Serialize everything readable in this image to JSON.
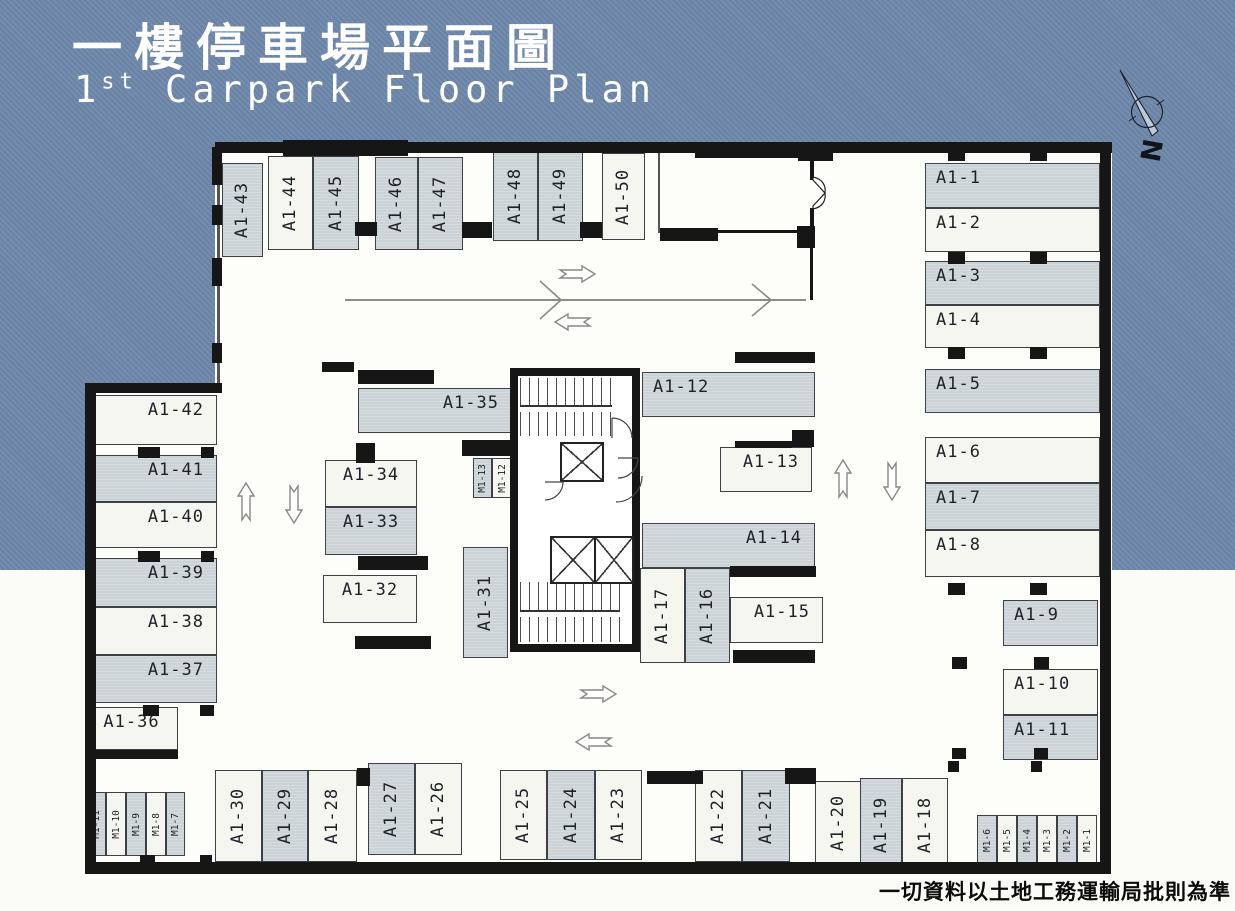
{
  "header": {
    "title_zh": "一樓停車場平面圖",
    "title_en_num": "1",
    "title_en_sup": "st",
    "title_en_rest": " Carpark Floor Plan"
  },
  "compass_label": "N",
  "footer_note": "一切資料以土地工務運輸局批則為準",
  "palette": {
    "background_blue": "#6d87aa",
    "stall_gray": "#ccd3d7",
    "stall_white": "#f6f6f1",
    "wall_black": "#161616"
  },
  "stalls": [
    {
      "label": "A1-43",
      "x": 222,
      "y": 163,
      "w": 41,
      "h": 94,
      "fill": "gray",
      "dir": "v"
    },
    {
      "label": "A1-44",
      "x": 268,
      "y": 156,
      "w": 45,
      "h": 94,
      "fill": "white",
      "dir": "v"
    },
    {
      "label": "A1-45",
      "x": 313,
      "y": 156,
      "w": 46,
      "h": 94,
      "fill": "gray",
      "dir": "v"
    },
    {
      "label": "A1-46",
      "x": 375,
      "y": 157,
      "w": 43,
      "h": 93,
      "fill": "gray",
      "dir": "v"
    },
    {
      "label": "A1-47",
      "x": 418,
      "y": 157,
      "w": 45,
      "h": 93,
      "fill": "gray",
      "dir": "v"
    },
    {
      "label": "A1-48",
      "x": 493,
      "y": 151,
      "w": 45,
      "h": 90,
      "fill": "gray",
      "dir": "v"
    },
    {
      "label": "A1-49",
      "x": 538,
      "y": 151,
      "w": 45,
      "h": 90,
      "fill": "gray",
      "dir": "v"
    },
    {
      "label": "A1-50",
      "x": 602,
      "y": 153,
      "w": 43,
      "h": 87,
      "fill": "white",
      "dir": "v"
    },
    {
      "label": "A1-1",
      "x": 925,
      "y": 163,
      "w": 175,
      "h": 45,
      "fill": "gray",
      "dir": "h",
      "align": "left"
    },
    {
      "label": "A1-2",
      "x": 925,
      "y": 208,
      "w": 175,
      "h": 44,
      "fill": "white",
      "dir": "h",
      "align": "left"
    },
    {
      "label": "A1-3",
      "x": 925,
      "y": 261,
      "w": 175,
      "h": 44,
      "fill": "gray",
      "dir": "h",
      "align": "left"
    },
    {
      "label": "A1-4",
      "x": 925,
      "y": 305,
      "w": 175,
      "h": 43,
      "fill": "white",
      "dir": "h",
      "align": "left"
    },
    {
      "label": "A1-5",
      "x": 925,
      "y": 369,
      "w": 175,
      "h": 44,
      "fill": "gray",
      "dir": "h",
      "align": "left"
    },
    {
      "label": "A1-6",
      "x": 925,
      "y": 437,
      "w": 175,
      "h": 46,
      "fill": "white",
      "dir": "h",
      "align": "left"
    },
    {
      "label": "A1-7",
      "x": 925,
      "y": 483,
      "w": 175,
      "h": 47,
      "fill": "gray",
      "dir": "h",
      "align": "left"
    },
    {
      "label": "A1-8",
      "x": 925,
      "y": 530,
      "w": 175,
      "h": 47,
      "fill": "white",
      "dir": "h",
      "align": "left"
    },
    {
      "label": "A1-9",
      "x": 1003,
      "y": 600,
      "w": 95,
      "h": 46,
      "fill": "gray",
      "dir": "h",
      "align": "left"
    },
    {
      "label": "A1-10",
      "x": 1003,
      "y": 669,
      "w": 95,
      "h": 46,
      "fill": "white",
      "dir": "h",
      "align": "left"
    },
    {
      "label": "A1-11",
      "x": 1003,
      "y": 715,
      "w": 95,
      "h": 45,
      "fill": "gray",
      "dir": "h",
      "align": "left"
    },
    {
      "label": "A1-42",
      "x": 88,
      "y": 395,
      "w": 129,
      "h": 50,
      "fill": "white",
      "dir": "h",
      "align": "right"
    },
    {
      "label": "A1-41",
      "x": 88,
      "y": 455,
      "w": 129,
      "h": 47,
      "fill": "gray",
      "dir": "h",
      "align": "right"
    },
    {
      "label": "A1-40",
      "x": 88,
      "y": 502,
      "w": 129,
      "h": 46,
      "fill": "white",
      "dir": "h",
      "align": "right"
    },
    {
      "label": "A1-39",
      "x": 88,
      "y": 558,
      "w": 129,
      "h": 49,
      "fill": "gray",
      "dir": "h",
      "align": "right"
    },
    {
      "label": "A1-38",
      "x": 88,
      "y": 607,
      "w": 129,
      "h": 48,
      "fill": "white",
      "dir": "h",
      "align": "right"
    },
    {
      "label": "A1-37",
      "x": 88,
      "y": 655,
      "w": 129,
      "h": 48,
      "fill": "gray",
      "dir": "h",
      "align": "right"
    },
    {
      "label": "A1-36",
      "x": 85,
      "y": 707,
      "w": 93,
      "h": 43,
      "fill": "white",
      "dir": "h",
      "align": "center"
    },
    {
      "label": "A1-35",
      "x": 358,
      "y": 388,
      "w": 154,
      "h": 45,
      "fill": "gray",
      "dir": "h",
      "align": "right"
    },
    {
      "label": "A1-34",
      "x": 325,
      "y": 460,
      "w": 92,
      "h": 47,
      "fill": "white",
      "dir": "h",
      "align": "center"
    },
    {
      "label": "A1-33",
      "x": 325,
      "y": 507,
      "w": 92,
      "h": 48,
      "fill": "gray",
      "dir": "h",
      "align": "center"
    },
    {
      "label": "A1-32",
      "x": 323,
      "y": 575,
      "w": 94,
      "h": 48,
      "fill": "white",
      "dir": "h",
      "align": "center"
    },
    {
      "label": "M1-13",
      "x": 473,
      "y": 458,
      "w": 19,
      "h": 40,
      "fill": "gray",
      "dir": "v",
      "size": "m"
    },
    {
      "label": "M1-12",
      "x": 492,
      "y": 458,
      "w": 20,
      "h": 40,
      "fill": "white",
      "dir": "v",
      "size": "m"
    },
    {
      "label": "A1-31",
      "x": 463,
      "y": 547,
      "w": 45,
      "h": 111,
      "fill": "gray",
      "dir": "v"
    },
    {
      "label": "A1-12",
      "x": 642,
      "y": 372,
      "w": 173,
      "h": 45,
      "fill": "gray",
      "dir": "h",
      "align": "left"
    },
    {
      "label": "A1-13",
      "x": 720,
      "y": 447,
      "w": 92,
      "h": 45,
      "fill": "white",
      "dir": "h",
      "align": "right"
    },
    {
      "label": "A1-14",
      "x": 642,
      "y": 523,
      "w": 173,
      "h": 45,
      "fill": "gray",
      "dir": "h",
      "align": "right"
    },
    {
      "label": "A1-15",
      "x": 730,
      "y": 597,
      "w": 93,
      "h": 46,
      "fill": "white",
      "dir": "h",
      "align": "right"
    },
    {
      "label": "A1-17",
      "x": 640,
      "y": 568,
      "w": 45,
      "h": 95,
      "fill": "white",
      "dir": "v"
    },
    {
      "label": "A1-16",
      "x": 685,
      "y": 568,
      "w": 45,
      "h": 95,
      "fill": "gray",
      "dir": "v"
    },
    {
      "label": "M1-11",
      "x": 86,
      "y": 792,
      "w": 20,
      "h": 64,
      "fill": "gray",
      "dir": "v",
      "size": "m"
    },
    {
      "label": "M1-10",
      "x": 106,
      "y": 792,
      "w": 20,
      "h": 64,
      "fill": "white",
      "dir": "v",
      "size": "m"
    },
    {
      "label": "M1-9",
      "x": 126,
      "y": 792,
      "w": 20,
      "h": 64,
      "fill": "gray",
      "dir": "v",
      "size": "m"
    },
    {
      "label": "M1-8",
      "x": 146,
      "y": 792,
      "w": 20,
      "h": 64,
      "fill": "white",
      "dir": "v",
      "size": "m"
    },
    {
      "label": "M1-7",
      "x": 166,
      "y": 792,
      "w": 19,
      "h": 64,
      "fill": "gray",
      "dir": "v",
      "size": "m"
    },
    {
      "label": "A1-30",
      "x": 215,
      "y": 770,
      "w": 47,
      "h": 92,
      "fill": "white",
      "dir": "v"
    },
    {
      "label": "A1-29",
      "x": 262,
      "y": 770,
      "w": 46,
      "h": 92,
      "fill": "gray",
      "dir": "v"
    },
    {
      "label": "A1-28",
      "x": 308,
      "y": 770,
      "w": 49,
      "h": 92,
      "fill": "white",
      "dir": "v"
    },
    {
      "label": "A1-27",
      "x": 368,
      "y": 763,
      "w": 47,
      "h": 92,
      "fill": "gray",
      "dir": "v"
    },
    {
      "label": "A1-26",
      "x": 415,
      "y": 763,
      "w": 47,
      "h": 92,
      "fill": "white",
      "dir": "v"
    },
    {
      "label": "A1-25",
      "x": 500,
      "y": 770,
      "w": 47,
      "h": 90,
      "fill": "white",
      "dir": "v"
    },
    {
      "label": "A1-24",
      "x": 547,
      "y": 770,
      "w": 48,
      "h": 90,
      "fill": "gray",
      "dir": "v"
    },
    {
      "label": "A1-23",
      "x": 595,
      "y": 770,
      "w": 47,
      "h": 90,
      "fill": "white",
      "dir": "v"
    },
    {
      "label": "A1-22",
      "x": 695,
      "y": 770,
      "w": 47,
      "h": 92,
      "fill": "white",
      "dir": "v"
    },
    {
      "label": "A1-21",
      "x": 742,
      "y": 770,
      "w": 48,
      "h": 92,
      "fill": "gray",
      "dir": "v"
    },
    {
      "label": "A1-20",
      "x": 815,
      "y": 781,
      "w": 47,
      "h": 84,
      "fill": "white",
      "dir": "v"
    },
    {
      "label": "A1-19",
      "x": 860,
      "y": 778,
      "w": 42,
      "h": 94,
      "fill": "gray",
      "dir": "v"
    },
    {
      "label": "A1-18",
      "x": 902,
      "y": 778,
      "w": 46,
      "h": 94,
      "fill": "white",
      "dir": "v"
    },
    {
      "label": "M1-6",
      "x": 977,
      "y": 815,
      "w": 20,
      "h": 50,
      "fill": "gray",
      "dir": "v",
      "size": "m"
    },
    {
      "label": "M1-5",
      "x": 997,
      "y": 815,
      "w": 20,
      "h": 50,
      "fill": "white",
      "dir": "v",
      "size": "m"
    },
    {
      "label": "M1-4",
      "x": 1017,
      "y": 815,
      "w": 20,
      "h": 50,
      "fill": "gray",
      "dir": "v",
      "size": "m"
    },
    {
      "label": "M1-3",
      "x": 1037,
      "y": 815,
      "w": 20,
      "h": 50,
      "fill": "white",
      "dir": "v",
      "size": "m"
    },
    {
      "label": "M1-2",
      "x": 1057,
      "y": 815,
      "w": 20,
      "h": 50,
      "fill": "gray",
      "dir": "v",
      "size": "m"
    },
    {
      "label": "M1-1",
      "x": 1077,
      "y": 815,
      "w": 20,
      "h": 50,
      "fill": "white",
      "dir": "v",
      "size": "m"
    }
  ],
  "walls": [
    [
      215,
      142,
      897,
      11
    ],
    [
      1100,
      142,
      11,
      731
    ],
    [
      85,
      862,
      1026,
      12
    ],
    [
      85,
      383,
      11,
      491
    ],
    [
      85,
      383,
      137,
      10
    ]
  ],
  "stubs": [
    [
      212,
      147,
      10,
      38
    ],
    [
      212,
      205,
      10,
      20
    ],
    [
      212,
      258,
      10,
      28
    ],
    [
      212,
      343,
      10,
      20
    ],
    [
      355,
      222,
      22,
      14
    ],
    [
      462,
      222,
      30,
      16
    ],
    [
      580,
      222,
      22,
      16
    ],
    [
      283,
      140,
      125,
      16
    ],
    [
      695,
      146,
      112,
      12
    ],
    [
      798,
      148,
      35,
      13
    ],
    [
      660,
      228,
      58,
      13
    ],
    [
      797,
      226,
      18,
      22
    ],
    [
      810,
      158,
      4,
      22
    ],
    [
      810,
      208,
      4,
      20
    ],
    [
      948,
      150,
      17,
      11
    ],
    [
      1030,
      150,
      17,
      11
    ],
    [
      948,
      252,
      17,
      12
    ],
    [
      1030,
      252,
      17,
      12
    ],
    [
      948,
      347,
      17,
      12
    ],
    [
      1030,
      347,
      17,
      12
    ],
    [
      948,
      583,
      17,
      12
    ],
    [
      1030,
      583,
      17,
      12
    ],
    [
      952,
      657,
      15,
      12
    ],
    [
      1034,
      657,
      15,
      12
    ],
    [
      952,
      748,
      14,
      11
    ],
    [
      1034,
      748,
      14,
      11
    ],
    [
      138,
      447,
      22,
      11
    ],
    [
      201,
      447,
      13,
      11
    ],
    [
      138,
      551,
      22,
      11
    ],
    [
      201,
      551,
      13,
      11
    ],
    [
      143,
      705,
      16,
      11
    ],
    [
      200,
      705,
      14,
      11
    ],
    [
      140,
      855,
      15,
      12
    ],
    [
      200,
      855,
      12,
      12
    ],
    [
      322,
      362,
      32,
      10
    ],
    [
      358,
      370,
      76,
      14
    ],
    [
      356,
      443,
      19,
      20
    ],
    [
      358,
      556,
      70,
      14
    ],
    [
      355,
      636,
      76,
      13
    ],
    [
      462,
      440,
      50,
      16
    ],
    [
      735,
      352,
      80,
      11
    ],
    [
      792,
      430,
      22,
      17
    ],
    [
      735,
      441,
      57,
      7
    ],
    [
      730,
      566,
      86,
      11
    ],
    [
      733,
      650,
      82,
      13
    ],
    [
      357,
      768,
      13,
      18
    ],
    [
      647,
      771,
      56,
      13
    ],
    [
      785,
      768,
      31,
      16
    ],
    [
      948,
      761,
      11,
      11
    ],
    [
      1031,
      761,
      11,
      11
    ],
    [
      85,
      750,
      93,
      9
    ],
    [
      810,
      247,
      3,
      53
    ],
    [
      718,
      230,
      80,
      3
    ]
  ],
  "arrows": [
    {
      "dir": "right",
      "x": 560,
      "y": 266
    },
    {
      "dir": "left",
      "x": 555,
      "y": 314
    },
    {
      "dir": "up",
      "x": 238,
      "y": 483
    },
    {
      "dir": "down",
      "x": 286,
      "y": 486
    },
    {
      "dir": "up",
      "x": 835,
      "y": 460
    },
    {
      "dir": "down",
      "x": 884,
      "y": 463
    },
    {
      "dir": "right",
      "x": 581,
      "y": 686
    },
    {
      "dir": "left",
      "x": 576,
      "y": 734
    }
  ]
}
